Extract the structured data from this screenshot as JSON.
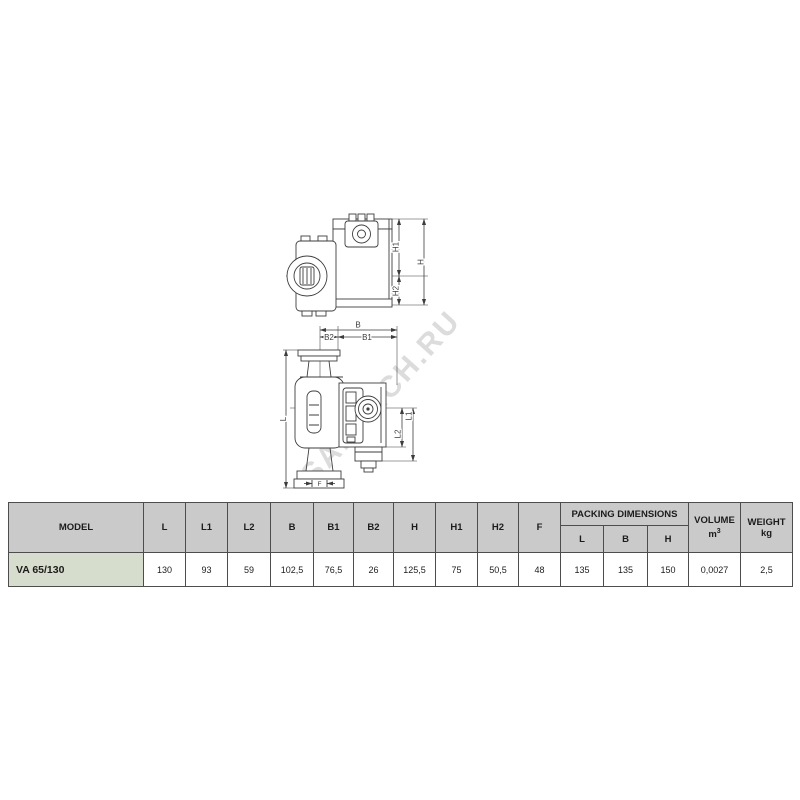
{
  "watermark": {
    "text": "SANTECH.RU",
    "color": "#c6c6c6"
  },
  "drawing": {
    "view_top": {
      "h1": "H1",
      "h": "H",
      "h2": "H2"
    },
    "view_front": {
      "b": "B",
      "b2": "B2",
      "b1": "B1",
      "l": "L",
      "l1": "L1",
      "l2": "L2",
      "f": "F"
    }
  },
  "table": {
    "header": {
      "model": "MODEL",
      "dims": [
        "L",
        "L1",
        "L2",
        "B",
        "B1",
        "B2",
        "H",
        "H1",
        "H2",
        "F"
      ],
      "packing_title": "PACKING DIMENSIONS",
      "packing_sub": [
        "L",
        "B",
        "H"
      ],
      "volume_title": "VOLUME",
      "volume_unit_base": "m",
      "volume_unit_sup": "3",
      "weight_title": "WEIGHT",
      "weight_unit": "kg"
    },
    "rows": [
      {
        "model": "VA 65/130",
        "values": [
          "130",
          "93",
          "59",
          "102,5",
          "76,5",
          "26",
          "125,5",
          "75",
          "50,5",
          "48",
          "135",
          "135",
          "150",
          "0,0027",
          "2,5"
        ]
      }
    ],
    "colors": {
      "header_bg": "#cacaca",
      "model_bg": "#d6ddcc",
      "border": "#4d4d4d",
      "line": "#3d3d3d"
    }
  }
}
